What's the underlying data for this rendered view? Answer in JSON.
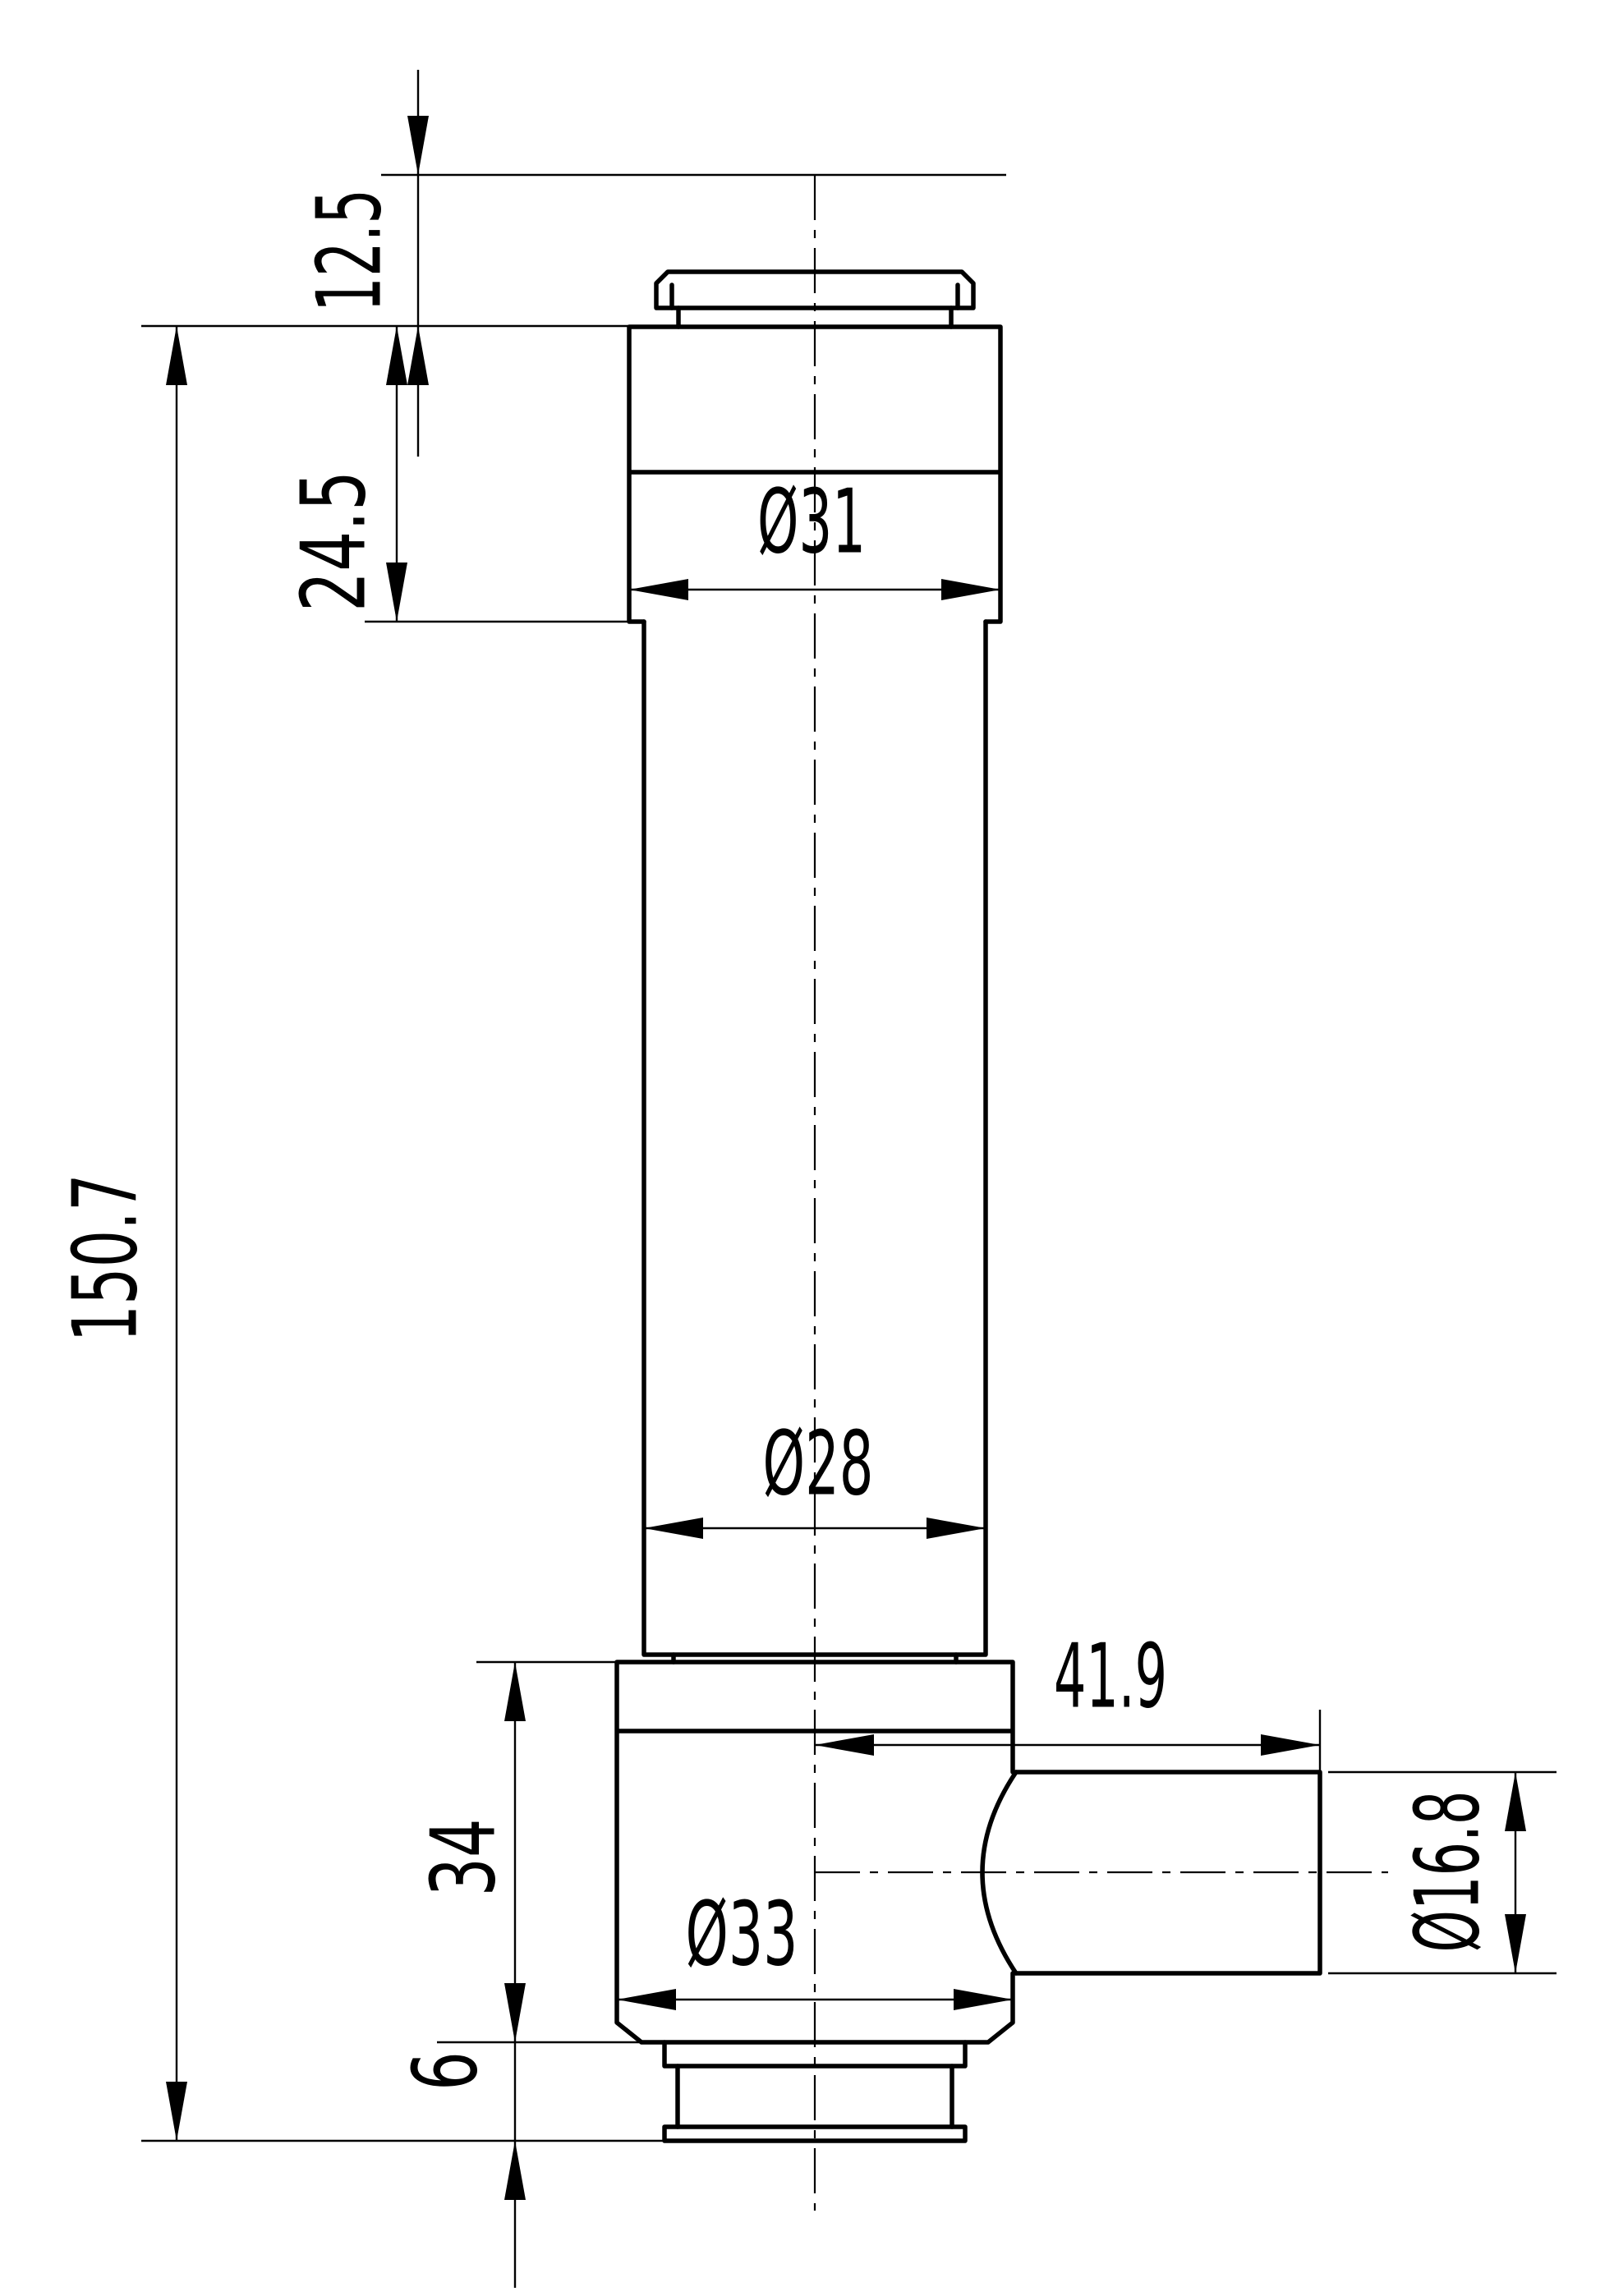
{
  "drawing": {
    "background_color": "#ffffff",
    "line_color": "#000000",
    "view": "front-section-free technical part view with dimensions"
  },
  "dimensions": {
    "cap_height": {
      "label": "12.5",
      "value": 12.5,
      "orientation": "vertical"
    },
    "upper_block_height": {
      "label": "24.5",
      "value": 24.5,
      "orientation": "vertical"
    },
    "overall_height": {
      "label": "150.7",
      "value": 150.7,
      "orientation": "vertical"
    },
    "upper_block_diameter": {
      "label": "Ø31",
      "value": 31,
      "orientation": "horizontal"
    },
    "body_diameter": {
      "label": "Ø28",
      "value": 28,
      "orientation": "horizontal"
    },
    "port_length": {
      "label": "41.9",
      "value": 41.9,
      "orientation": "horizontal"
    },
    "lower_block_height": {
      "label": "34",
      "value": 34,
      "orientation": "vertical"
    },
    "lower_block_diameter": {
      "label": "Ø33",
      "value": 33,
      "orientation": "horizontal"
    },
    "flange_height": {
      "label": "6",
      "value": 6,
      "orientation": "vertical"
    },
    "port_diameter": {
      "label": "Ø16.8",
      "value": 16.8,
      "orientation": "vertical"
    }
  }
}
